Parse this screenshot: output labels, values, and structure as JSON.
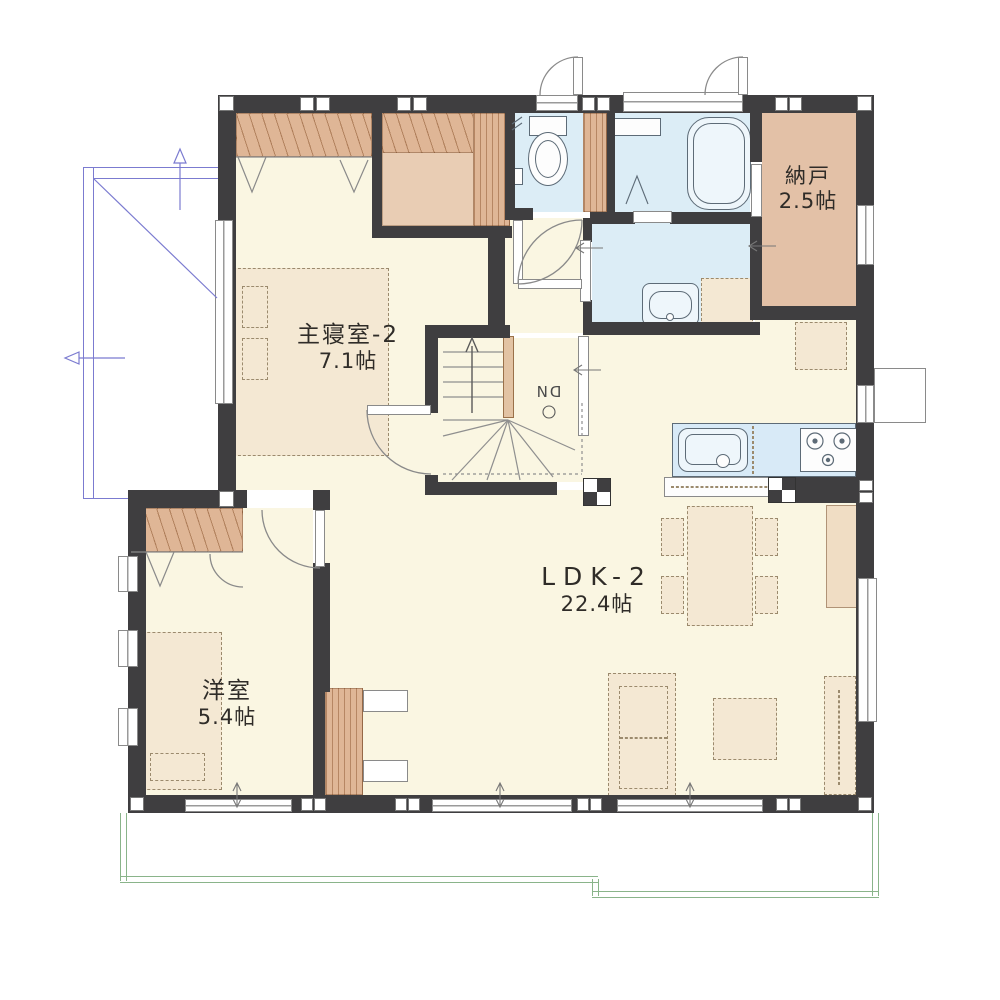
{
  "rooms": {
    "master_bedroom": {
      "name": "主寝室-2",
      "area": "7.1帖"
    },
    "storage": {
      "name": "納戸",
      "area": "2.5帖"
    },
    "ldk": {
      "name": "LDK-2",
      "area": "22.4帖"
    },
    "western_room": {
      "name": "洋室",
      "area": "5.4帖"
    }
  },
  "stairs": {
    "down_label": "DN"
  },
  "colors": {
    "wall": "#3f3e40",
    "floor-cream": "#faf6e2",
    "wet-blue": "#dcedf6",
    "room-tan": "#e3c1a7",
    "closet-tan": "#dfb696",
    "furniture-tan": "#f4e8d3",
    "furniture-line": "#9b8a6d",
    "counter-blue": "#d8eaf7",
    "balcony-green": "#8ab48a",
    "annotation-blue": "#7b7bd0",
    "text": "#2f2c28"
  }
}
